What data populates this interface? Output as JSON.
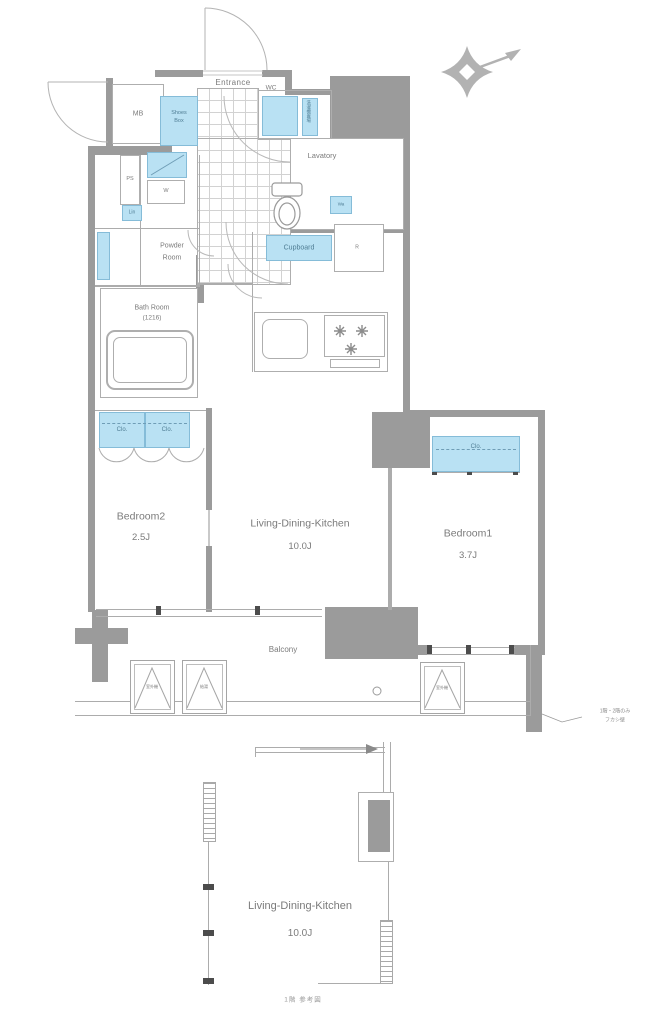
{
  "rooms": {
    "entrance": "Entrance",
    "mb": "MB",
    "shoes_line1": "Shoes",
    "shoes_line2": "Box",
    "wc": "WC",
    "wc_strip_vertical": "洗濯機置場",
    "lavatory": "Lavatory",
    "ps": "PS",
    "washer": "W",
    "linen": "Lin",
    "powder_line1": "Powder",
    "powder_line2": "Room",
    "bath_line1": "Bath Room",
    "bath_line2": "(1216)",
    "cupboard": "Cupboard",
    "storage_small": "Wa",
    "fridge": "R",
    "bedroom2": "Bedroom2",
    "bedroom2_size": "2.5J",
    "ldk": "Living-Dining-Kitchen",
    "ldk_size": "10.0J",
    "bedroom1": "Bedroom1",
    "bedroom1_size": "3.7J",
    "balcony": "Balcony"
  },
  "closets": [
    "Clo.",
    "Clo.",
    "Clo."
  ],
  "outdoor_units": [
    "室外機",
    "給湯",
    "室外機"
  ],
  "wall_note": {
    "line1": "1階・2階のみ",
    "line2": "フカシ壁"
  },
  "lower_plan": {
    "ldk": "Living-Dining-Kitchen",
    "size": "10.0J",
    "caption": "1階 参考図"
  },
  "colors": {
    "wall": "#9b9b9b",
    "fixture_fill": "#b9e1f3",
    "fixture_border": "#85bcd8",
    "line": "#acacac",
    "text": "#7b7b7b"
  }
}
